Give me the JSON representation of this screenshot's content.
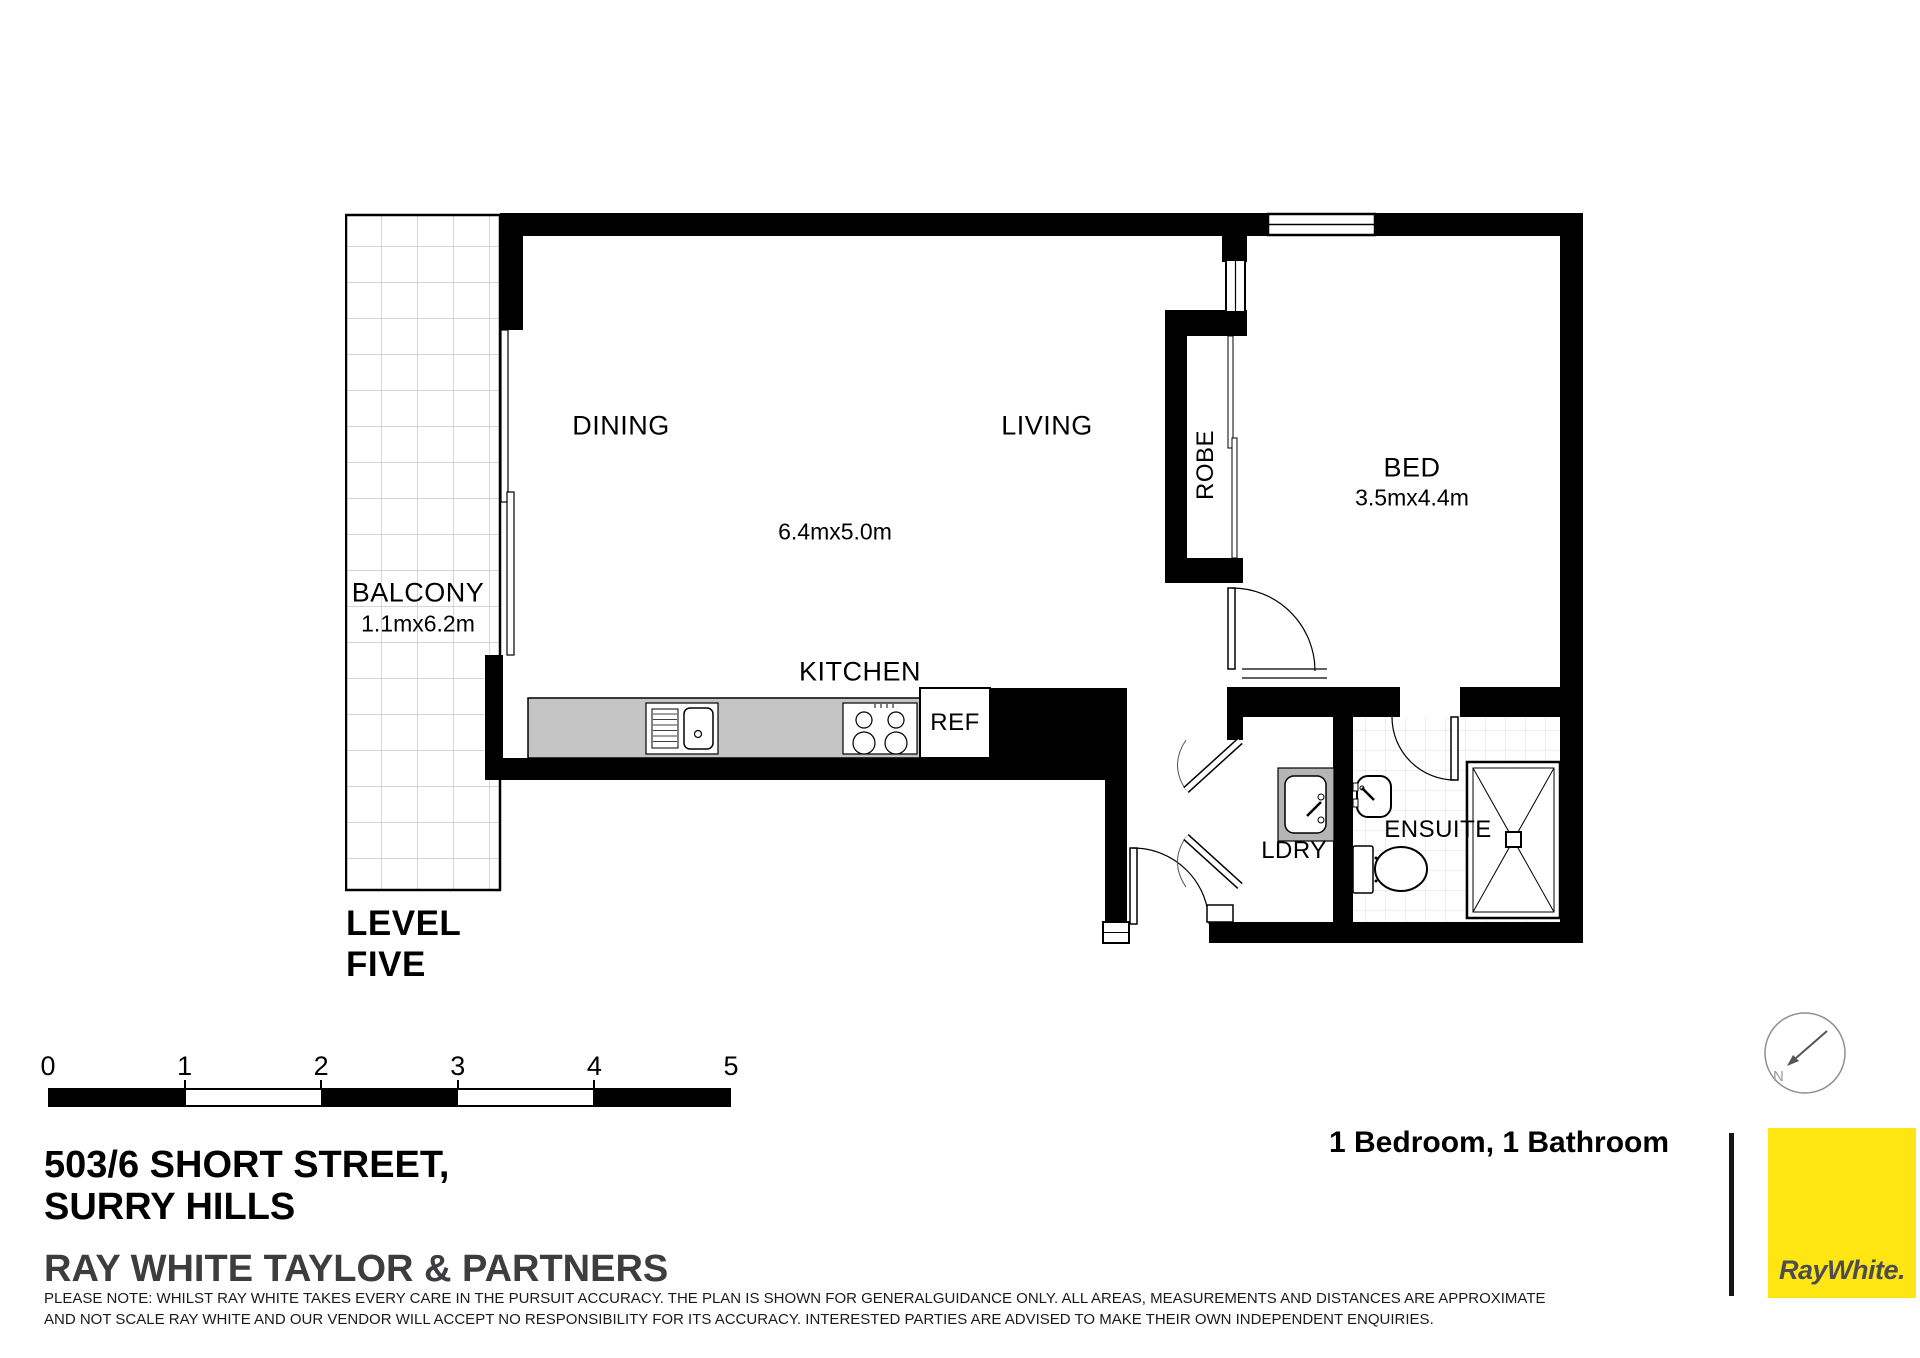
{
  "plan": {
    "rooms": {
      "balcony": {
        "label": "BALCONY",
        "dimensions": "1.1mx6.2m"
      },
      "dining": {
        "label": "DINING"
      },
      "living": {
        "label": "LIVING"
      },
      "living_dining_dimensions": "6.4mx5.0m",
      "kitchen": {
        "label": "KITCHEN"
      },
      "ref": {
        "label": "REF"
      },
      "robe": {
        "label": "ROBE"
      },
      "bed": {
        "label": "BED",
        "dimensions": "3.5mx4.4m"
      },
      "ldry": {
        "label": "LDRY"
      },
      "ensuite": {
        "label": "ENSUITE"
      }
    },
    "level": {
      "line1": "LEVEL",
      "line2": "FIVE"
    }
  },
  "scale_bar": {
    "ticks": [
      "0",
      "1",
      "2",
      "3",
      "4",
      "5"
    ]
  },
  "footer": {
    "address_line1": "503/6 SHORT STREET,",
    "address_line2": "SURRY HILLS",
    "agency": "RAY WHITE TAYLOR & PARTNERS",
    "disclaimer": "PLEASE NOTE: WHILST RAY WHITE TAKES EVERY CARE IN THE PURSUIT ACCURACY. THE PLAN IS SHOWN FOR GENERALGUIDANCE ONLY. ALL AREAS, MEASUREMENTS AND DISTANCES ARE APPROXIMATE AND NOT SCALE RAY WHITE AND OUR VENDOR WILL ACCEPT NO RESPONSIBILITY FOR ITS ACCURACY. INTERESTED PARTIES ARE ADVISED TO MAKE THEIR OWN INDEPENDENT ENQUIRIES.",
    "summary": "1 Bedroom, 1 Bathroom",
    "logo_text": "RayWhite.",
    "compass_label": "N"
  },
  "colors": {
    "wall": "#000000",
    "kitchen_counter": "#c5c5c5",
    "laundry_tub_surround": "#b5b5b5",
    "brand_yellow": "#ffe512",
    "agency_grey": "#3d3d3f",
    "logo_grey": "#4d4d4f"
  }
}
